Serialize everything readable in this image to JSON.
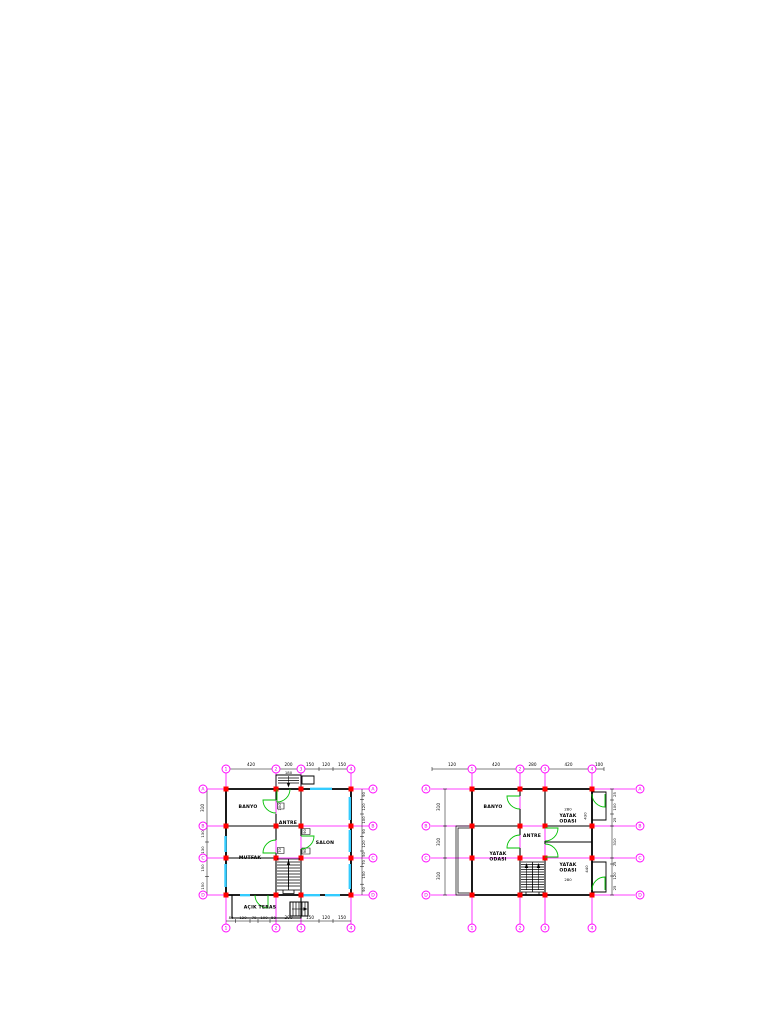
{
  "colors": {
    "grid_line": "#ff00ff",
    "column_marker": "#ff0000",
    "window": "#33ccff",
    "door": "#00c000",
    "wall": "#000000",
    "paper": "#ffffff"
  },
  "plan_left": {
    "grid_cols": [
      "1",
      "2",
      "3",
      "4"
    ],
    "grid_rows": [
      "A",
      "B",
      "C",
      "D"
    ],
    "rooms": {
      "banyo": "BANYO",
      "antre": "ANTRE",
      "mutfak": "MUTFAK",
      "salon": "SALON",
      "acik_teras": "AÇIK TERAS"
    },
    "dims": {
      "top": [
        "420",
        "200",
        "150",
        "120",
        "150"
      ],
      "porch_width": "180",
      "bottom": [
        "80",
        "120",
        "70",
        "100",
        "50",
        "200",
        "150",
        "120",
        "150"
      ],
      "left": [
        "310",
        "130",
        "130",
        "150",
        "150"
      ],
      "right": [
        "90",
        "120",
        "100",
        "90",
        "120",
        "50",
        "70",
        "150",
        "90"
      ],
      "doors": [
        "100",
        "70",
        "90",
        "90"
      ]
    }
  },
  "plan_right": {
    "grid_cols": [
      "1",
      "2",
      "3",
      "4"
    ],
    "grid_rows": [
      "A",
      "B",
      "C",
      "D"
    ],
    "rooms": {
      "banyo": "BANYO",
      "antre": "ANTRE",
      "yatak": [
        "YATAK",
        "ODASI"
      ]
    },
    "dims": {
      "top": [
        "120",
        "420",
        "280",
        "420",
        "100"
      ],
      "left": [
        "310",
        "310",
        "310"
      ],
      "right": [
        "25",
        "100",
        "25",
        "310",
        "25",
        "120",
        "25"
      ],
      "room_width_top": "280",
      "room_height_top": "430",
      "room_width_bottom": "280",
      "room_height_bottom": "440"
    }
  }
}
